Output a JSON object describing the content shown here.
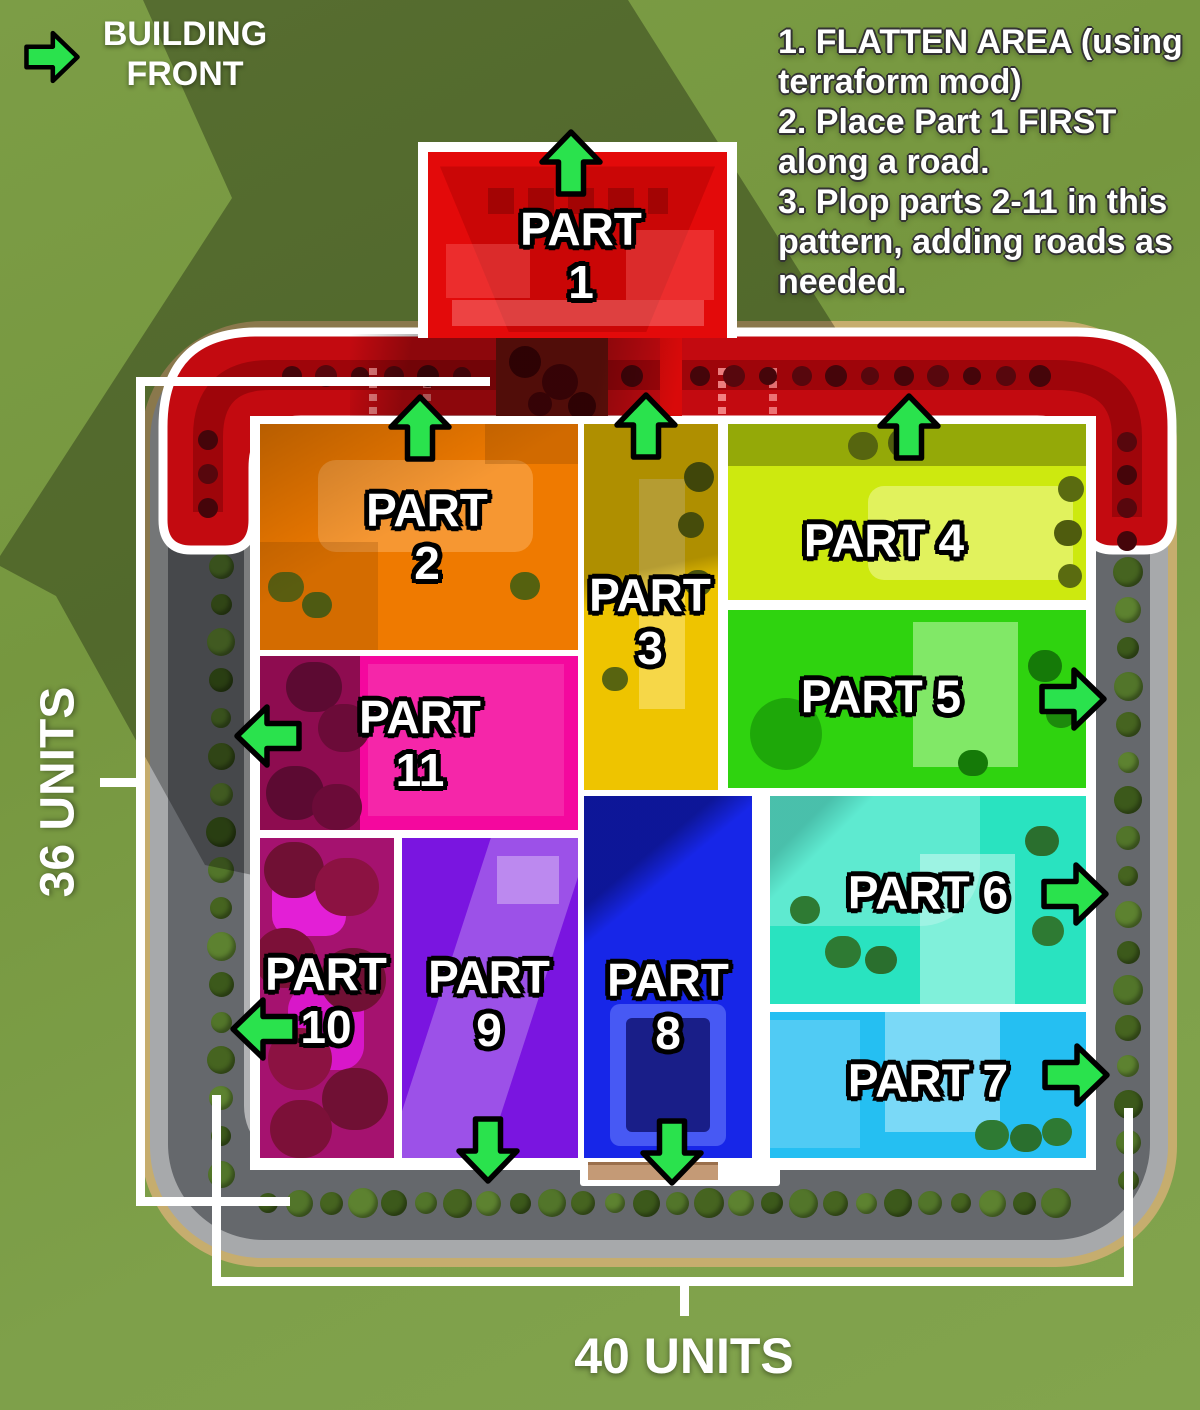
{
  "legend": {
    "line1": "BUILDING",
    "line2": "FRONT"
  },
  "instructions": {
    "lines": [
      "1. FLATTEN AREA (using",
      "terraform mod)",
      "2. Place Part 1 FIRST",
      "along a road.",
      "3. Plop parts 2-11 in this",
      "pattern, adding roads as",
      "needed."
    ]
  },
  "measurements": {
    "vertical": "36 UNITS",
    "horizontal": "40 UNITS"
  },
  "parts": [
    {
      "id": 1,
      "label": "PART",
      "number": "1",
      "color": "#e30a0a",
      "arrow_direction": "up"
    },
    {
      "id": 2,
      "label": "PART",
      "number": "2",
      "color": "#ef7a00",
      "arrow_direction": "up"
    },
    {
      "id": 3,
      "label": "PART",
      "number": "3",
      "color": "#eec400",
      "arrow_direction": "up"
    },
    {
      "id": 4,
      "label": "PART",
      "number": "4",
      "color": "#cde90f",
      "arrow_direction": "up"
    },
    {
      "id": 5,
      "label": "PART",
      "number": "5",
      "color": "#2fd30f",
      "arrow_direction": "right"
    },
    {
      "id": 6,
      "label": "PART",
      "number": "6",
      "color": "#29e3c0",
      "arrow_direction": "right"
    },
    {
      "id": 7,
      "label": "PART",
      "number": "7",
      "color": "#25bff2",
      "arrow_direction": "right"
    },
    {
      "id": 8,
      "label": "PART",
      "number": "8",
      "color": "#1726e8",
      "arrow_direction": "down"
    },
    {
      "id": 9,
      "label": "PART",
      "number": "9",
      "color": "#7a15e0",
      "arrow_direction": "down"
    },
    {
      "id": 10,
      "label": "PART",
      "number": "10",
      "color": "#a5126f",
      "arrow_direction": "left"
    },
    {
      "id": 11,
      "label": "PART",
      "number": "11",
      "color": "#f4089e",
      "arrow_direction": "left"
    }
  ],
  "colors": {
    "arrow_green": "#2ae24d",
    "outline_black": "#000000",
    "highlight_white": "#ffffff",
    "part1_road_red": "#c30a10"
  }
}
